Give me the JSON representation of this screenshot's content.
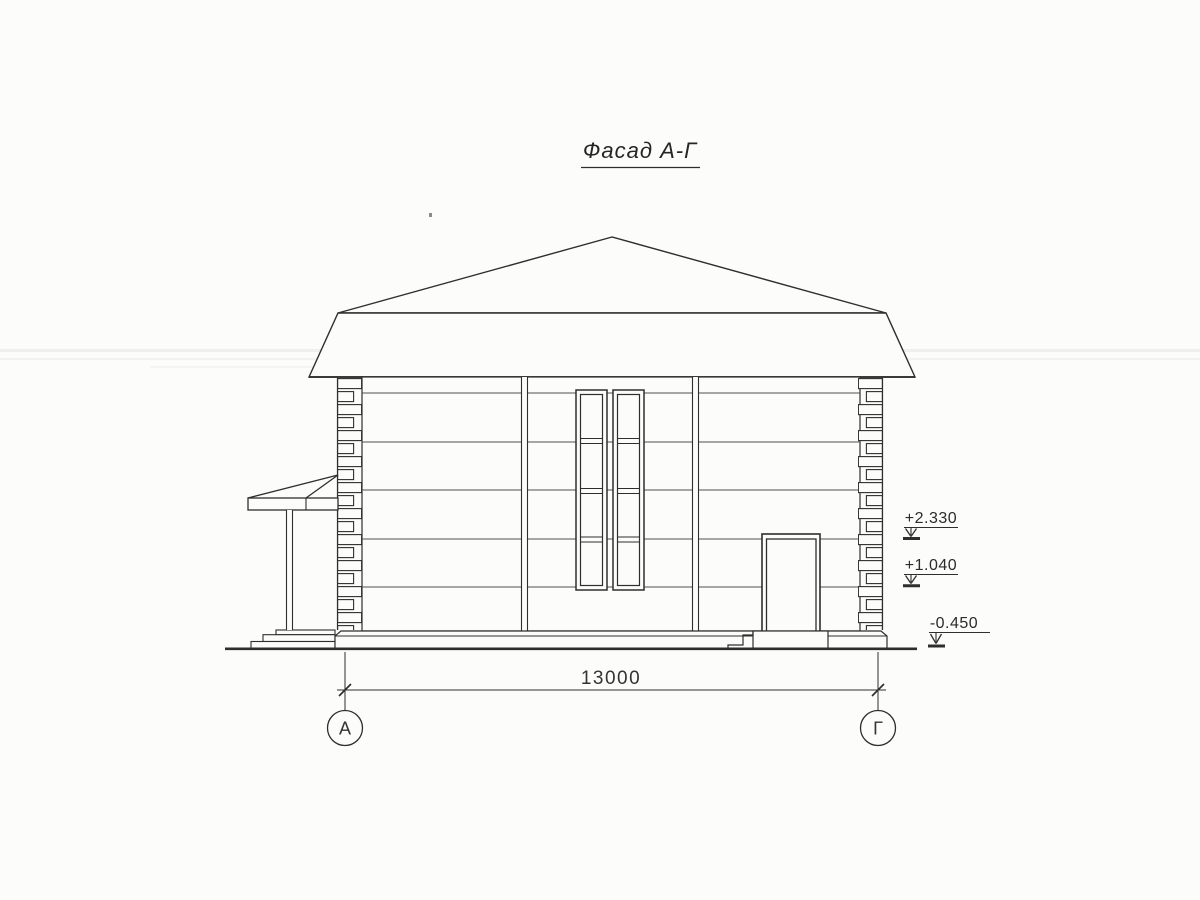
{
  "drawing": {
    "title": "Фасад А-Г",
    "dimension_label": "13000",
    "axes": {
      "left": "А",
      "right": "Г"
    },
    "elevation_marks": {
      "upper": "+2.330",
      "middle": "+1.040",
      "lower": "-0.450"
    },
    "colors": {
      "line": "#2e2e2e",
      "course_line": "#4f4f4f",
      "paper": "#fcfcfb"
    }
  }
}
